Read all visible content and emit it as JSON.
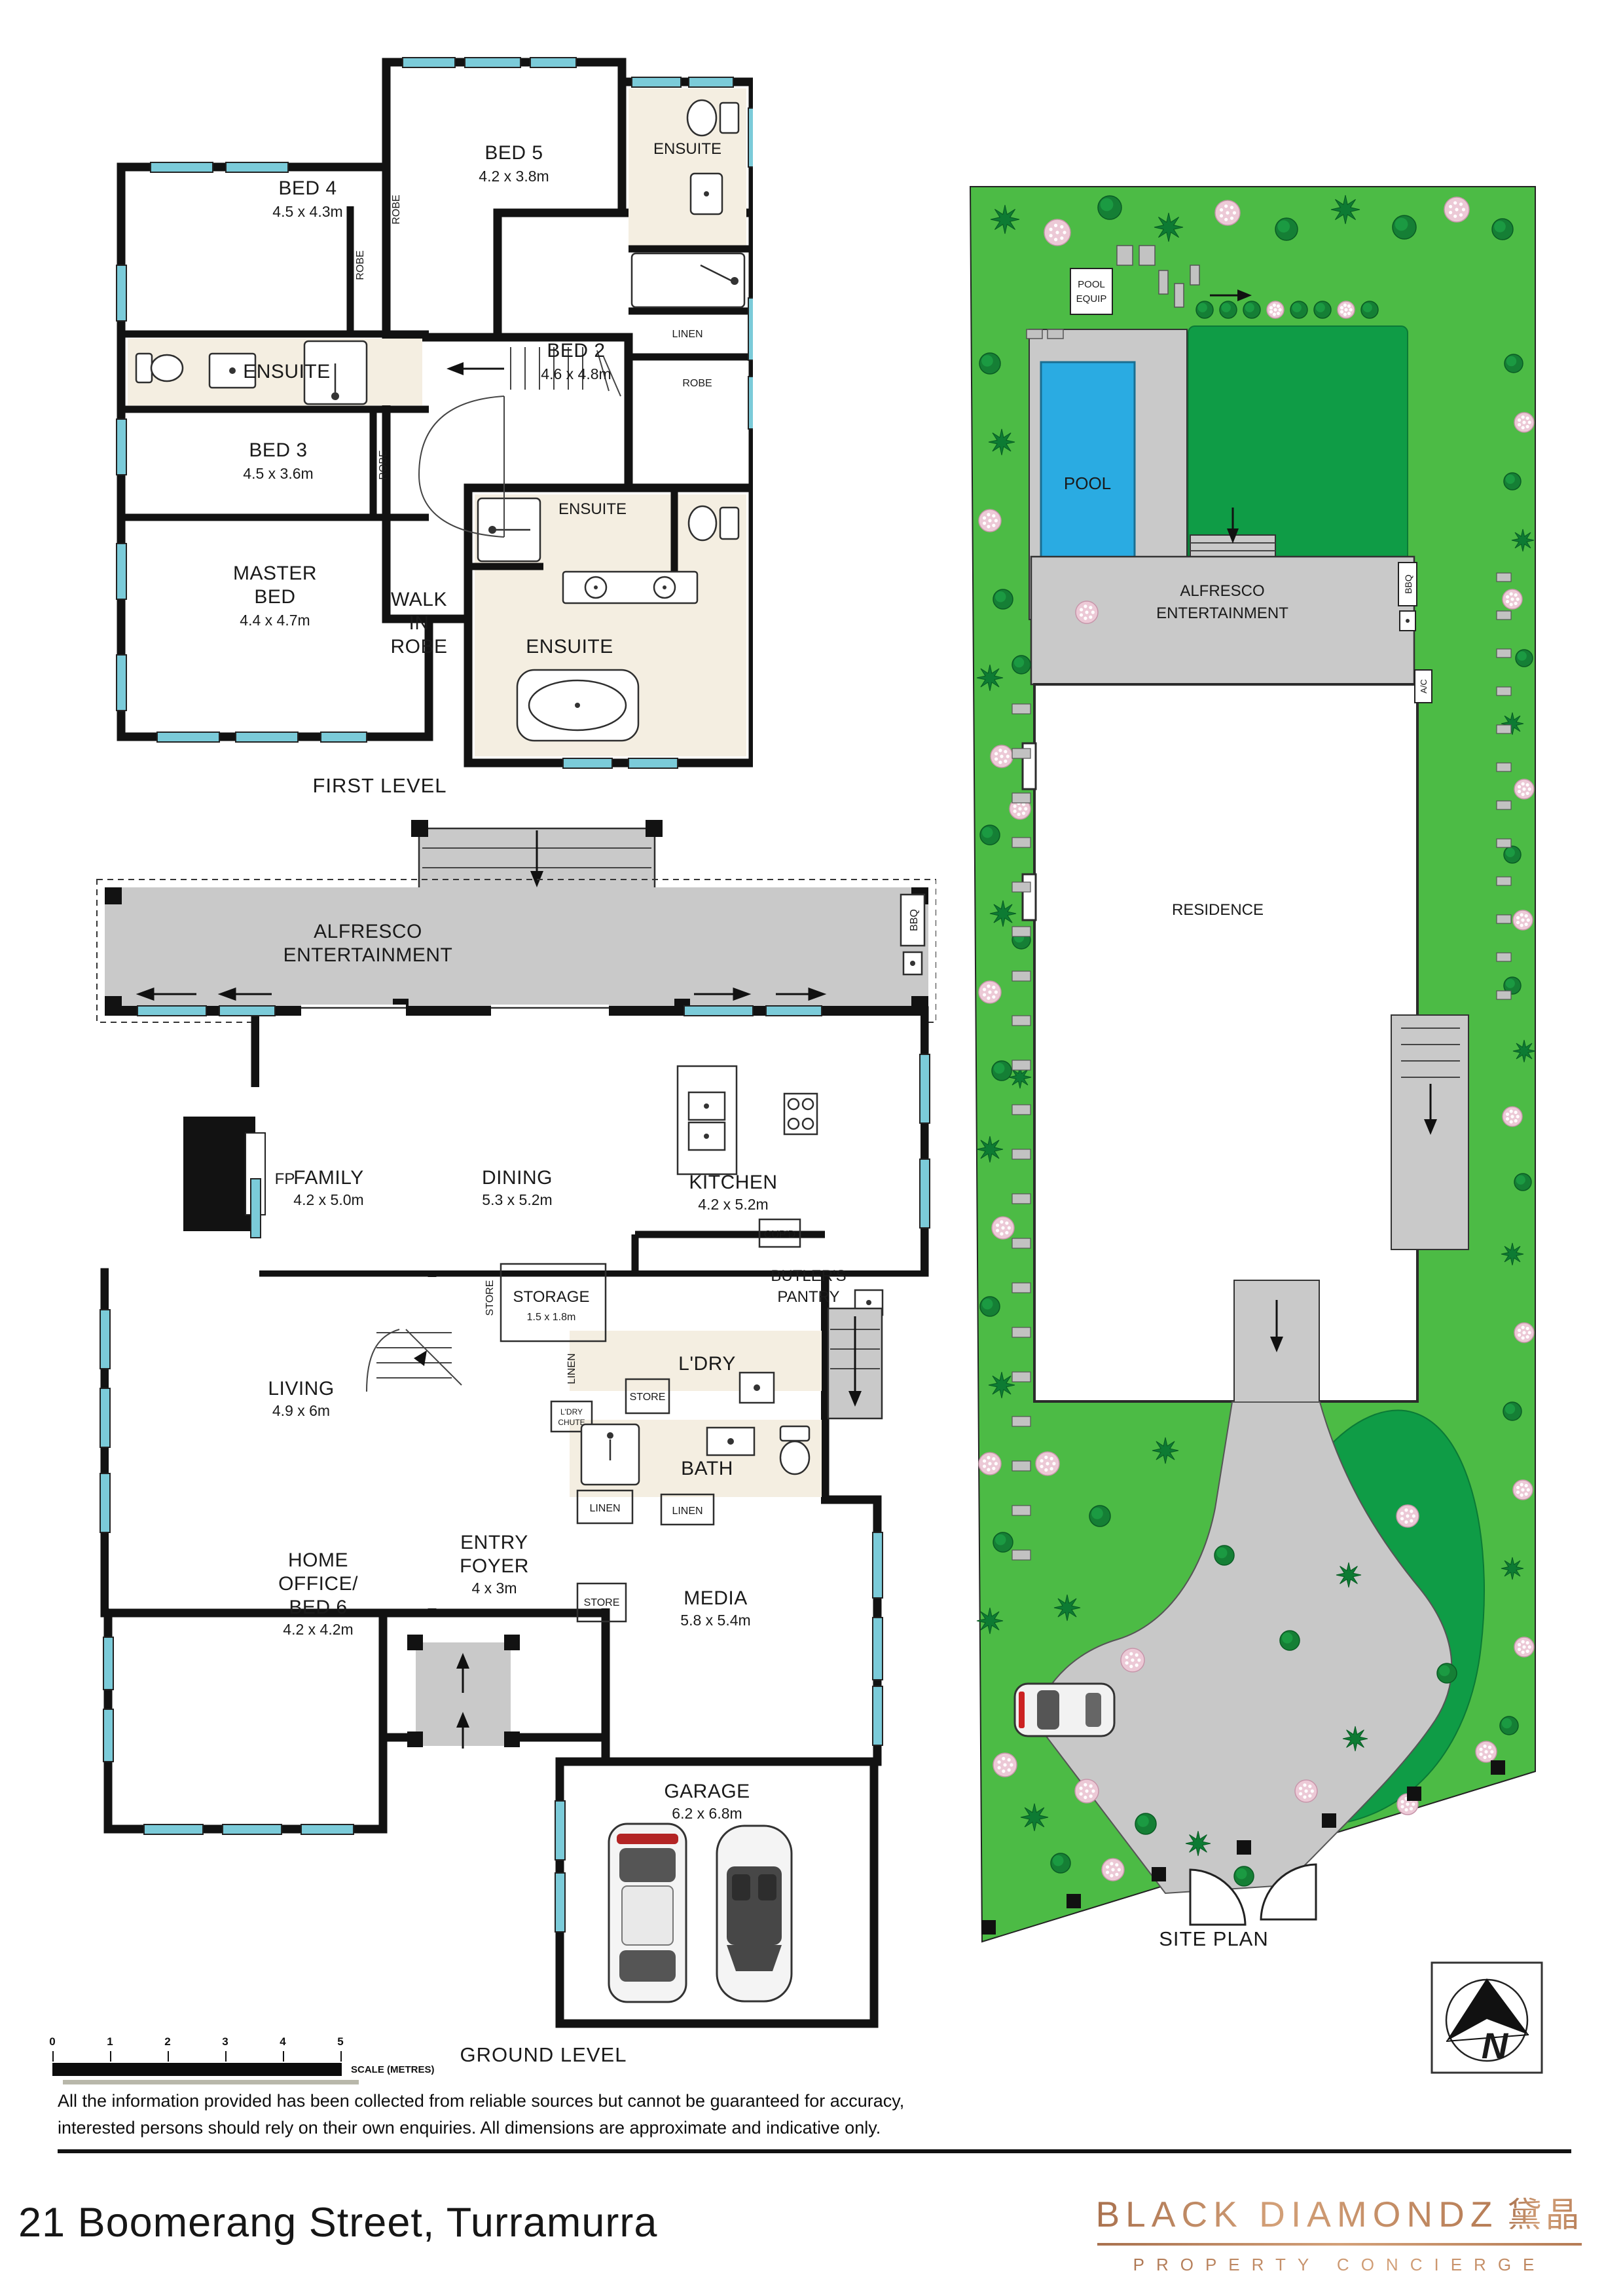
{
  "address": "21 Boomerang Street, Turramurra",
  "branding": {
    "name": "BLACK DIAMONDZ",
    "cjk": "黛晶",
    "tagline": "PROPERTY CONCIERGE",
    "accent_color": "#bf8a64"
  },
  "disclaimer": {
    "line1": "All the information provided has been collected from reliable sources but cannot be guaranteed for accuracy,",
    "line2": "interested persons should rely on their own enquiries. All dimensions are approximate and indicative only."
  },
  "scale_bar": {
    "t0": "0",
    "t1": "1",
    "t2": "2",
    "t3": "3",
    "t4": "4",
    "t5": "5",
    "label": "SCALE (METRES)"
  },
  "north": {
    "label": "N"
  },
  "colors": {
    "window": "#7bcbd9",
    "wall": "#121212",
    "alfresco_gray": "#c9c9c9",
    "pool_blue": "#2aabe2",
    "grass_light": "#4cbb45",
    "grass_dark": "#0f9c46",
    "tile": "#f4eee1"
  },
  "first_level": {
    "title": "FIRST LEVEL",
    "bed4": {
      "name": "BED 4",
      "dims": "4.5 x 4.3m"
    },
    "bed5": {
      "name": "BED 5",
      "dims": "4.2 x 3.8m"
    },
    "bed3": {
      "name": "BED 3",
      "dims": "4.5 x 3.6m"
    },
    "bed2": {
      "name": "BED 2",
      "dims": "4.6 x 4.8m"
    },
    "master": {
      "l1": "MASTER",
      "l2": "BED",
      "dims": "4.4 x 4.7m"
    },
    "wir": {
      "l1": "WALK",
      "l2": "IN",
      "l3": "ROBE"
    },
    "ensuite": "ENSUITE",
    "linen": "LINEN",
    "robe": "ROBE"
  },
  "ground_level": {
    "title": "GROUND LEVEL",
    "alfresco": {
      "l1": "ALFRESCO",
      "l2": "ENTERTAINMENT"
    },
    "family": {
      "name": "FAMILY",
      "dims": "4.2 x 5.0m"
    },
    "dining": {
      "name": "DINING",
      "dims": "5.3 x 5.2m"
    },
    "kitchen": {
      "name": "KITCHEN",
      "dims": "4.2 x 5.2m"
    },
    "butlers": {
      "l1": "BUTLER'S",
      "l2": "PANTRY"
    },
    "cupd": "CUP'D",
    "storage": {
      "name": "STORAGE",
      "dims": "1.5 x 1.8m"
    },
    "living": {
      "name": "LIVING",
      "dims": "4.9 x 6m"
    },
    "ldry": "L'DRY",
    "ldry_chute": {
      "l1": "L'DRY",
      "l2": "CHUTE"
    },
    "bath": "BATH",
    "entry": {
      "l1": "ENTRY",
      "l2": "FOYER",
      "dims": "4 x 3m"
    },
    "home_office": {
      "l1": "HOME",
      "l2": "OFFICE/",
      "l3": "BED 6",
      "dims": "4.2 x 4.2m"
    },
    "media": {
      "name": "MEDIA",
      "dims": "5.8 x 5.4m"
    },
    "garage": {
      "name": "GARAGE",
      "dims": "6.2 x 6.8m"
    },
    "fp": "FP",
    "store": "STORE",
    "linen": "LINEN",
    "bbq": "BBQ"
  },
  "site_plan": {
    "title": "SITE PLAN",
    "pool": "POOL",
    "pool_equip": {
      "l1": "POOL",
      "l2": "EQUIP"
    },
    "alfresco": {
      "l1": "ALFRESCO",
      "l2": "ENTERTAINMENT"
    },
    "residence": "RESIDENCE",
    "bbq": "BBQ",
    "ac": "A/C"
  }
}
